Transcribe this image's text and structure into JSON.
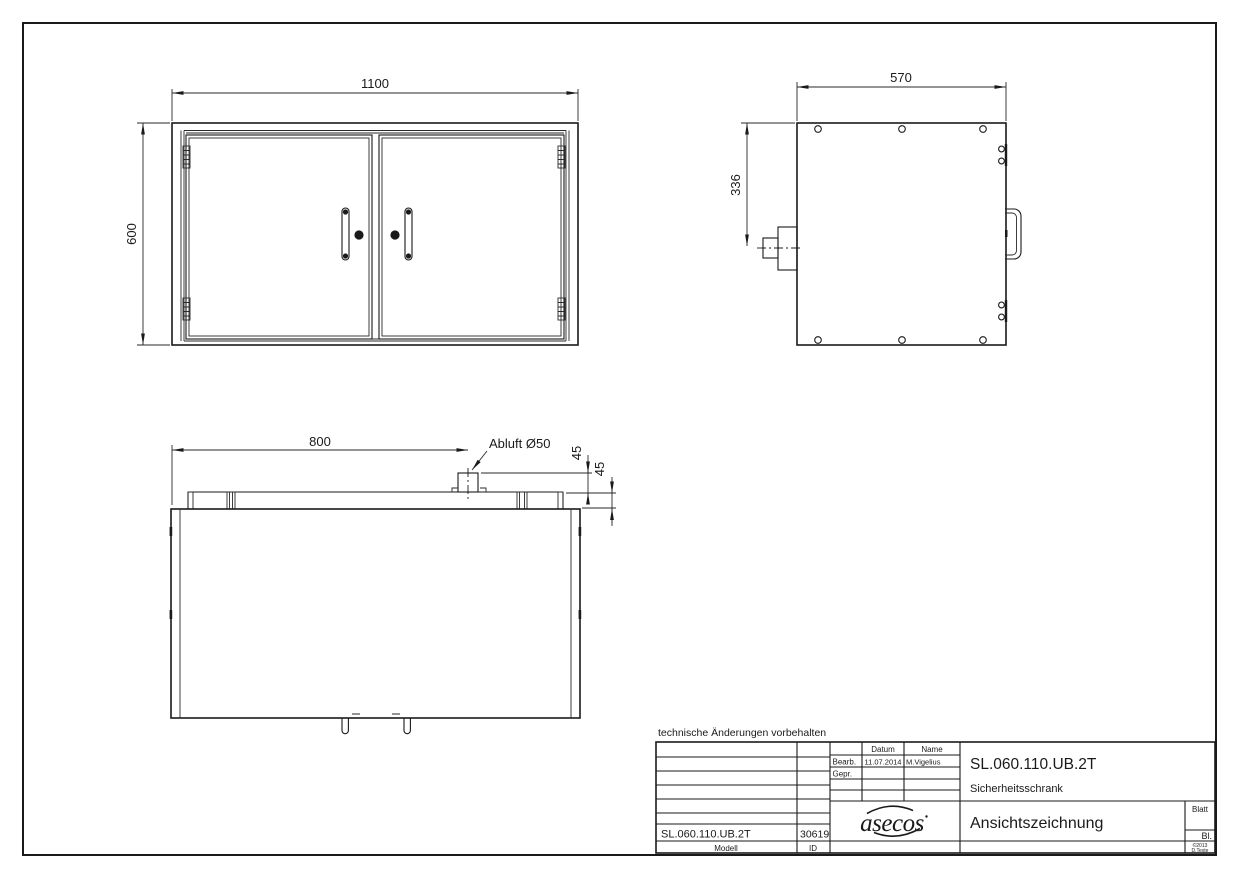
{
  "drawing": {
    "note": "technische Änderungen vorbehalten",
    "dimensions": {
      "front_width": "1100",
      "front_height": "600",
      "side_depth": "570",
      "side_duct_height": "336",
      "top_duct_x": "800",
      "duct_label": "Abluft Ø50",
      "duct_stub_height": "45",
      "rail_height": "45"
    },
    "title_block": {
      "header_datum": "Datum",
      "header_name": "Name",
      "row_bearb": "Bearb.",
      "row_gepr": "Gepr.",
      "bearb_datum": "11.07.2014",
      "bearb_name": "M.Vigelius",
      "model_number": "SL.060.110.UB.2T",
      "type_label": "Sicherheitsschrank",
      "view_label": "Ansichtszeichnung",
      "logo_text": "asecos",
      "blatt_label": "Blatt",
      "bl_label": "Bl.",
      "version_line1": "©2013",
      "version_line2": "D.Texte",
      "footer_model_value": "SL.060.110.UB.2T",
      "footer_id_value": "30619",
      "footer_model_label": "Modell",
      "footer_id_label": "ID"
    },
    "line_color": "#1a1a1a",
    "background": "#ffffff"
  }
}
